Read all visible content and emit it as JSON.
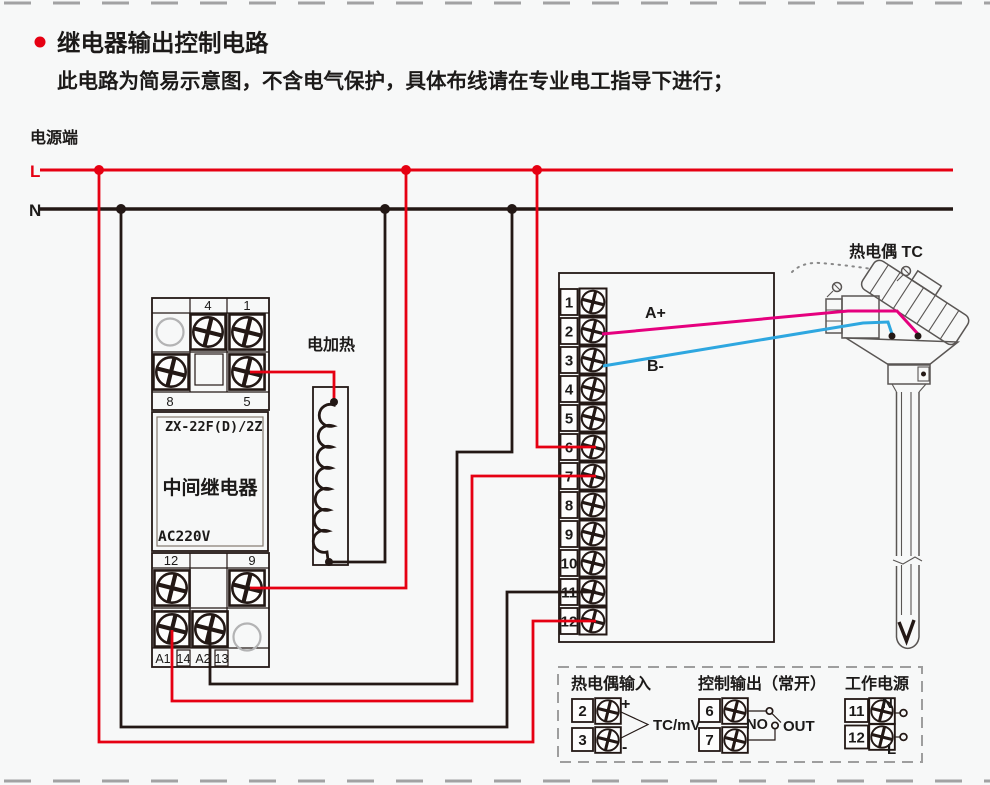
{
  "colors": {
    "background": "#f7f8f8",
    "line_red": "#e60012",
    "line_black": "#231815",
    "wire_pink": "#e5007e",
    "wire_blue": "#2ea7e0",
    "dash_gray": "#9e9e9e"
  },
  "header": {
    "title": "继电器输出控制电路",
    "subtitle": "此电路为简易示意图，不含电气保护，具体布线请在专业电工指导下进行；"
  },
  "power": {
    "label": "电源端",
    "live": "L",
    "neutral": "N"
  },
  "relay": {
    "model": "ZX-22F(D)/2Z",
    "name": "中间继电器",
    "voltage": "AC220V",
    "top": {
      "t4": "4",
      "t1": "1",
      "t8": "8",
      "t5": "5"
    },
    "bottom": {
      "t12": "12",
      "t9": "9",
      "a1": "A1",
      "n14": "14",
      "a2": "A2",
      "n13": "13"
    }
  },
  "heater": {
    "label": "电加热"
  },
  "thermocouple": {
    "label": "热电偶 TC"
  },
  "instrument": {
    "terminals": [
      "1",
      "2",
      "3",
      "4",
      "5",
      "6",
      "7",
      "8",
      "9",
      "10",
      "11",
      "12"
    ],
    "wire_a": "A+",
    "wire_b": "B-"
  },
  "legend": {
    "tc_input": {
      "title": "热电偶输入",
      "t2": "2",
      "t3": "3",
      "plus": "+",
      "minus": "-",
      "unit": "TC/mV"
    },
    "control_output": {
      "title": "控制输出（常开）",
      "t6": "6",
      "t7": "7",
      "no": "NO",
      "out": "OUT"
    },
    "work_power": {
      "title": "工作电源",
      "t11": "11",
      "t12": "12",
      "n": "N",
      "l": "L"
    }
  }
}
